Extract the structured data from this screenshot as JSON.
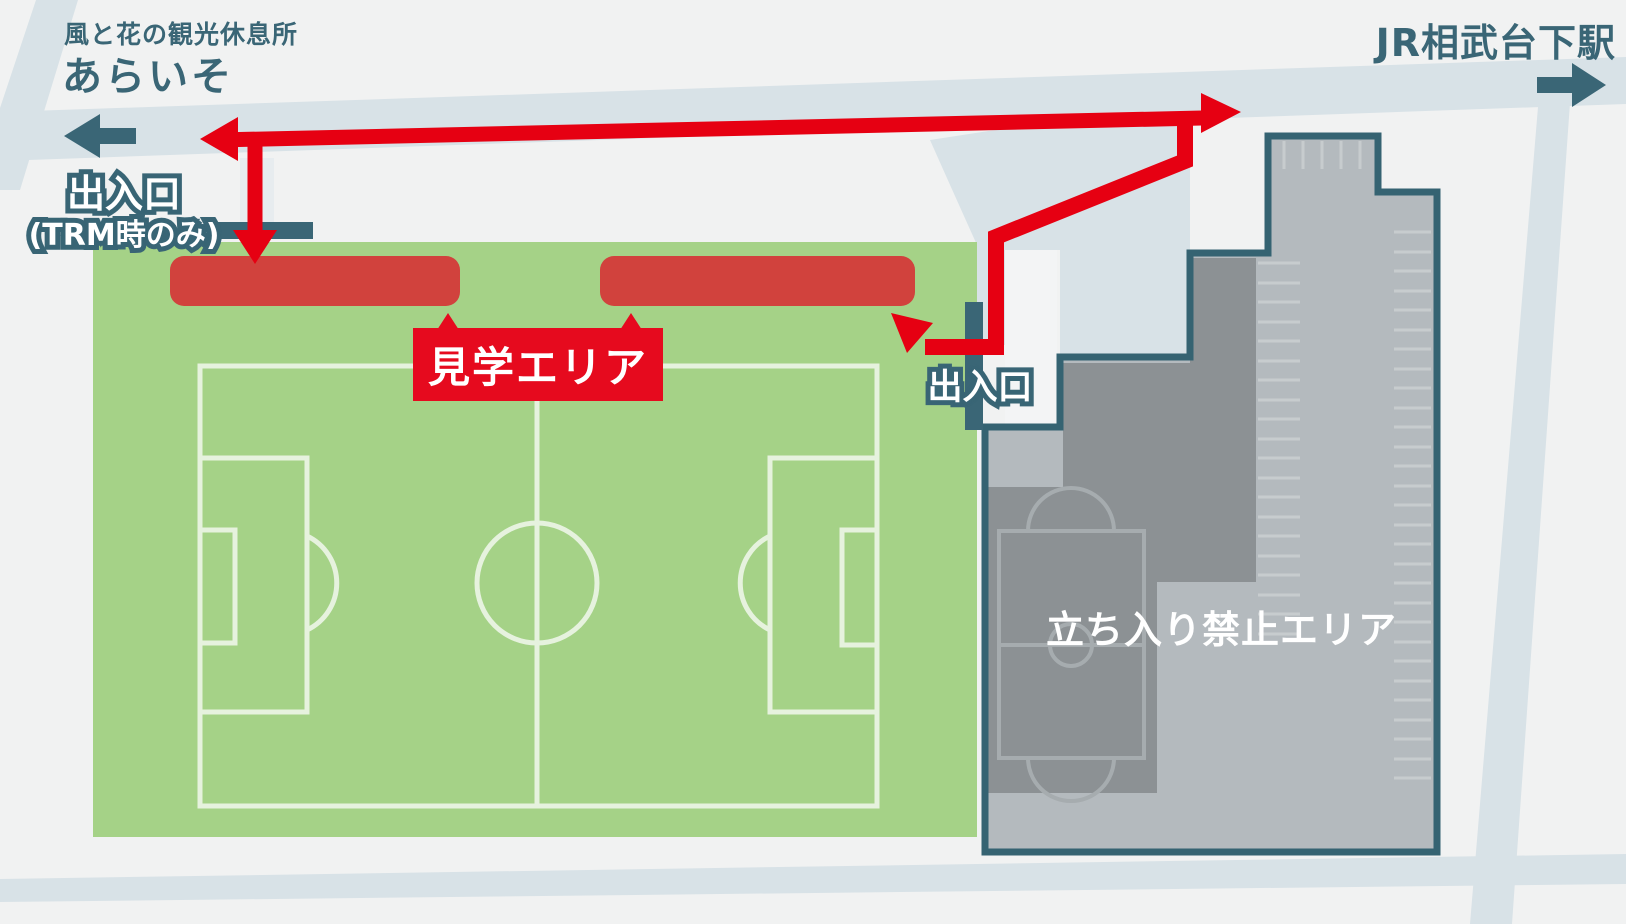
{
  "map_labels": {
    "rest_area_caption": "風と花の観光休息所",
    "rest_area_name": "あらいそ",
    "station_name": "JR相武台下駅",
    "trm_entrance_title": "出入口",
    "trm_entrance_note": "(TRM時のみ)",
    "viewing_area": "見学エリア",
    "field_entrance": "出入口",
    "restricted_area": "立ち入り禁止エリア"
  },
  "icons": {
    "west_arrow": "direction-to-rest-area-arrow",
    "east_arrow": "direction-to-station-arrow",
    "route_arrows": "red-walking-route-arrows"
  },
  "colors": {
    "background": "#f1f2f2",
    "road": "#d8e2e7",
    "driveway": "#e7ecef",
    "white_path": "#f3f4f5",
    "field_green": "#a5d287",
    "pitch_line": "#e6f2de",
    "stand_red": "#d1423d",
    "label_red": "#e60a1e",
    "route_red": "#e60012",
    "teal": "#3a6676",
    "complex_border": "#356372",
    "complex_fill": "#b4babe",
    "building_gray": "#8c9194",
    "court_line": "#a6acaf",
    "stall_line": "#c7ccce"
  }
}
